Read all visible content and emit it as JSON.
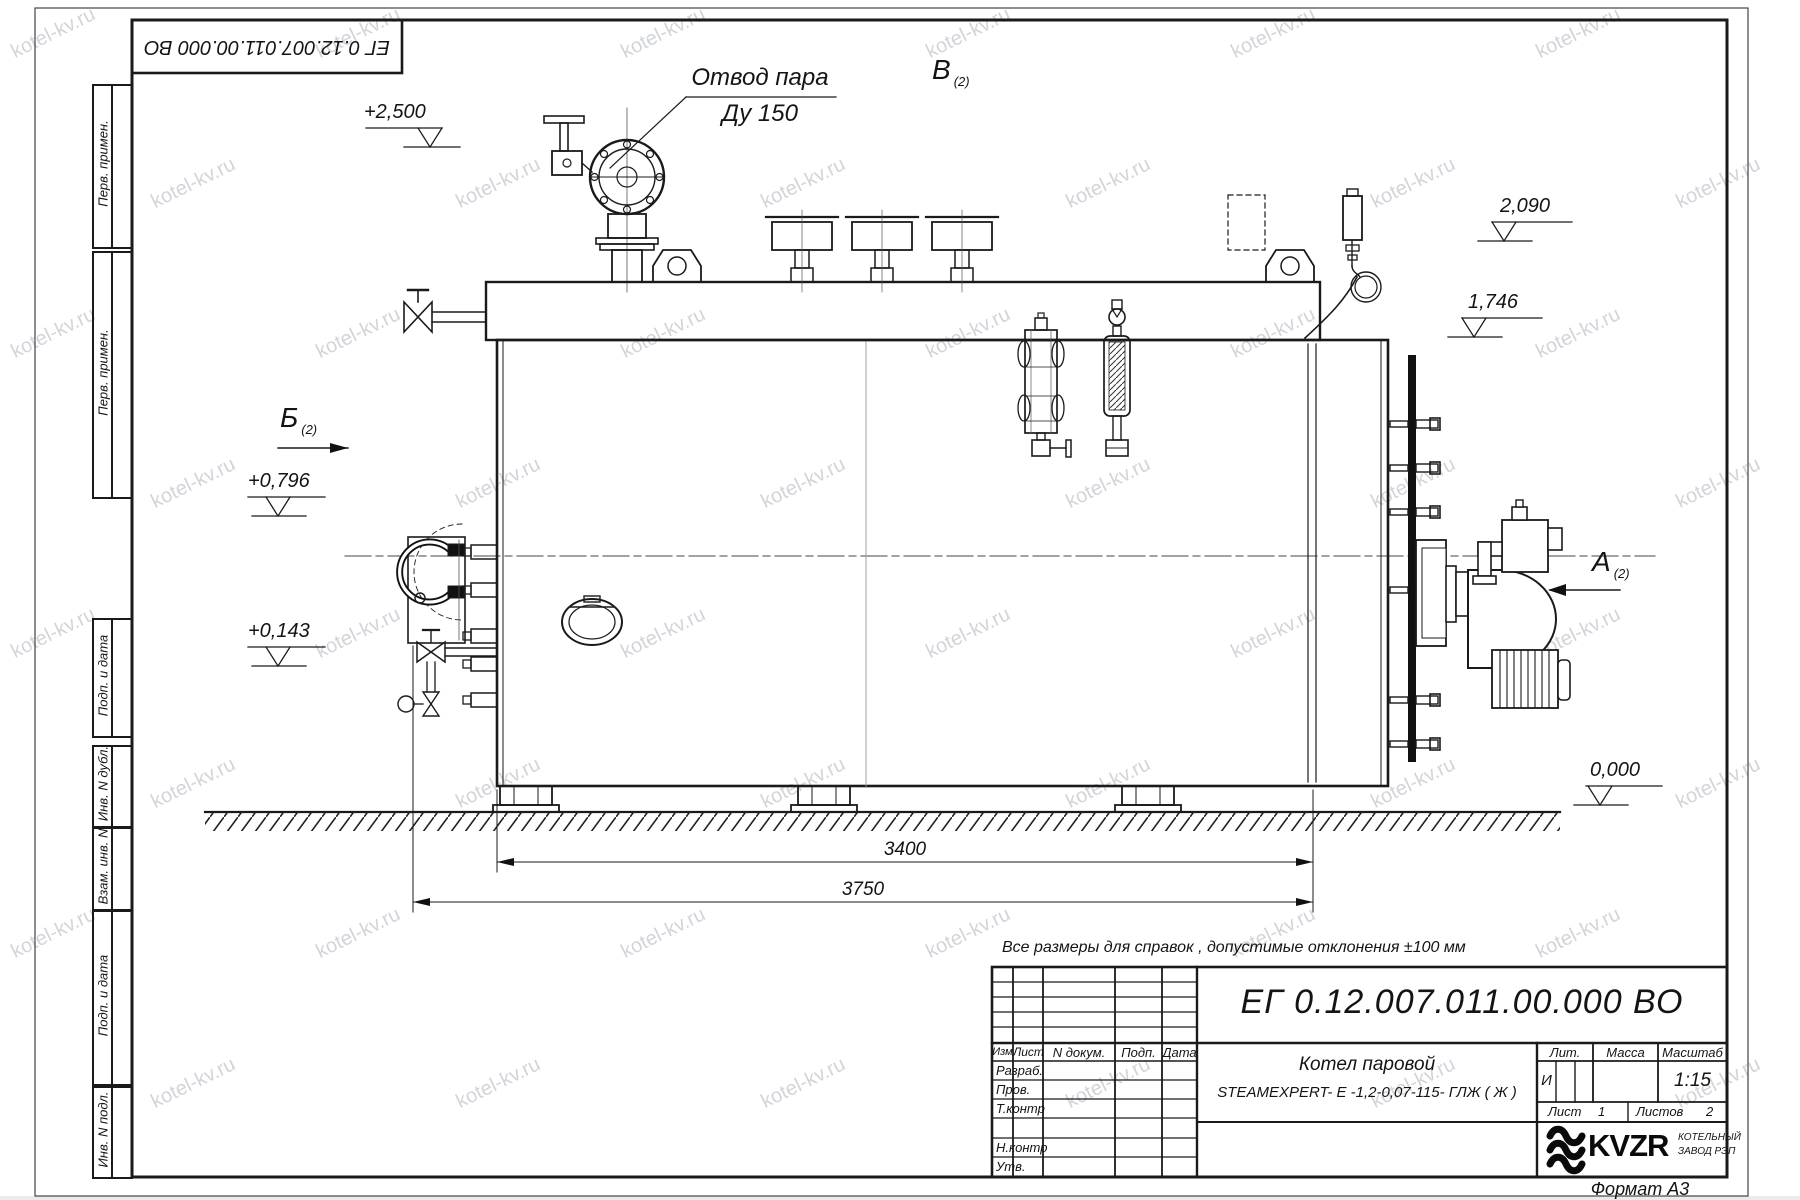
{
  "watermark": {
    "text": "kotel-kv.ru"
  },
  "stamp_top": {
    "doc_number": "ЕГ 0.12.007.011.00.000  ВО"
  },
  "margin": [
    "Перв. примен.",
    "Перв. примен.",
    "Подп. и дата",
    "Инв. N дубл.",
    "Взам. инв. N",
    "Подп. и дата",
    "Инв. N подл."
  ],
  "drawing": {
    "callout_line1": "Отвод пара",
    "callout_line2": "Ду 150",
    "views": {
      "a": {
        "letter": "А",
        "sub": "(2)"
      },
      "b": {
        "letter": "Б",
        "sub": "(2)"
      },
      "v": {
        "letter": "В",
        "sub": "(2)"
      }
    },
    "elevations": {
      "e2500": "+2,500",
      "e2090": "2,090",
      "e1746": "1,746",
      "e0796": "+0,796",
      "e0143": "+0,143",
      "e0000": "0,000"
    },
    "dims": {
      "length_inner": "3400",
      "length_outer": "3750"
    },
    "note": "Все размеры для справок , допустимые отклонения  ±100  мм"
  },
  "title_block": {
    "doc_number": "ЕГ 0.12.007.011.00.000  ВО",
    "name_line1": "Котел паровой",
    "name_line2": "STEAMEXPERT- Е -1,2-0,07-115- ГЛЖ ( Ж )",
    "col_izm": "Изм",
    "col_list": "Лист",
    "col_ndoc": "N докум.",
    "col_podp": "Подп.",
    "col_data": "Дата",
    "row_razrab": "Разраб.",
    "row_prov": "Пров.",
    "row_tkontr": "Т.контр",
    "row_nkontr": "Н.контр",
    "row_utv": "Утв.",
    "lit_header": "Лит.",
    "massa_header": "Масса",
    "masshtab_header": "Масштаб",
    "lit_value": "И",
    "masshtab_value": "1:15",
    "list_label": "Лист",
    "list_value": "1",
    "listov_label": "Листов",
    "listov_value": "2",
    "logo_text": "KVZR",
    "logo_sub1": "КОТЕЛЬНЫЙ",
    "logo_sub2": "ЗАВОД РЭП",
    "format_label": "Формат А3"
  }
}
